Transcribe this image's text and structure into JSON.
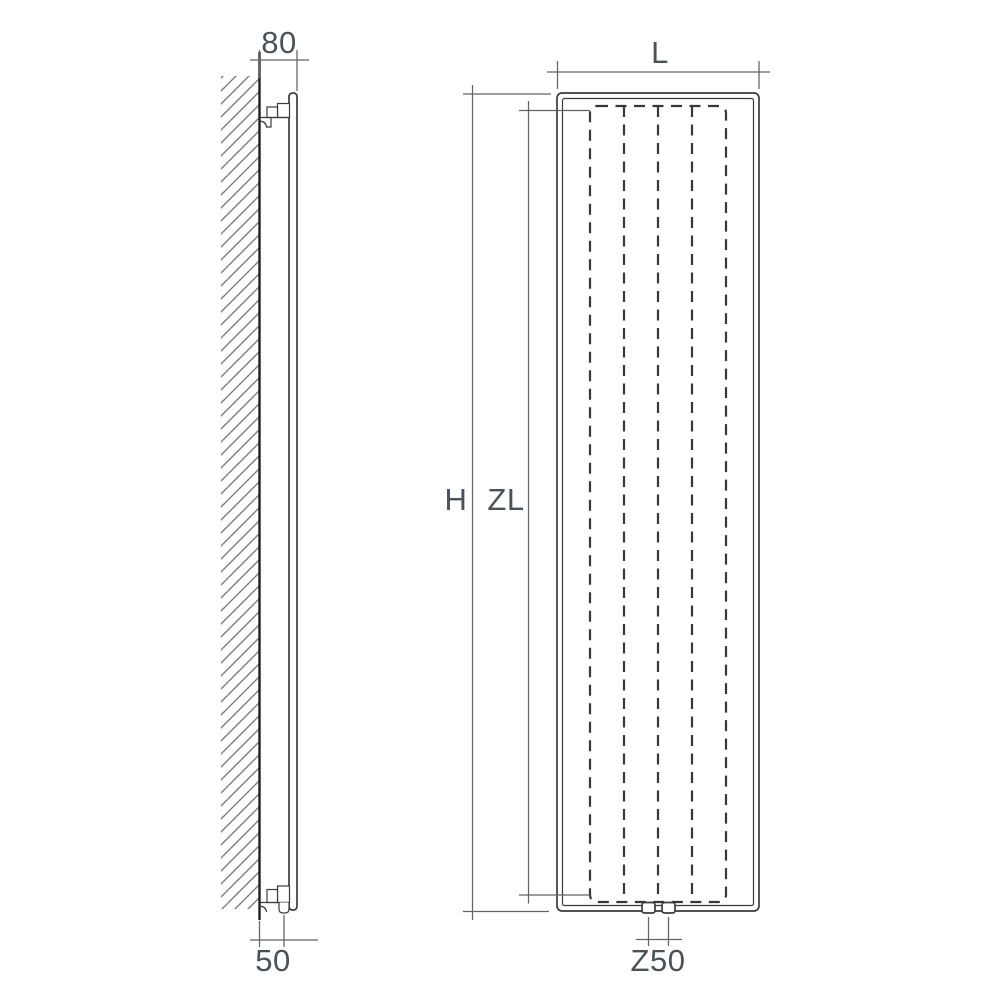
{
  "side_view": {
    "depth_label": "80",
    "connection_offset_label": "50"
  },
  "front_view": {
    "width_label": "L",
    "height_label": "H",
    "zone_length_label": "ZL",
    "connection_spacing_label": "Z50"
  },
  "colors": {
    "background": "#ffffff",
    "drawing_line": "#3b3b3b",
    "wall_line": "#202020",
    "hatch_line": "#7d7d7d",
    "dimension_line": "#5f6468",
    "label_text": "#47525b"
  }
}
